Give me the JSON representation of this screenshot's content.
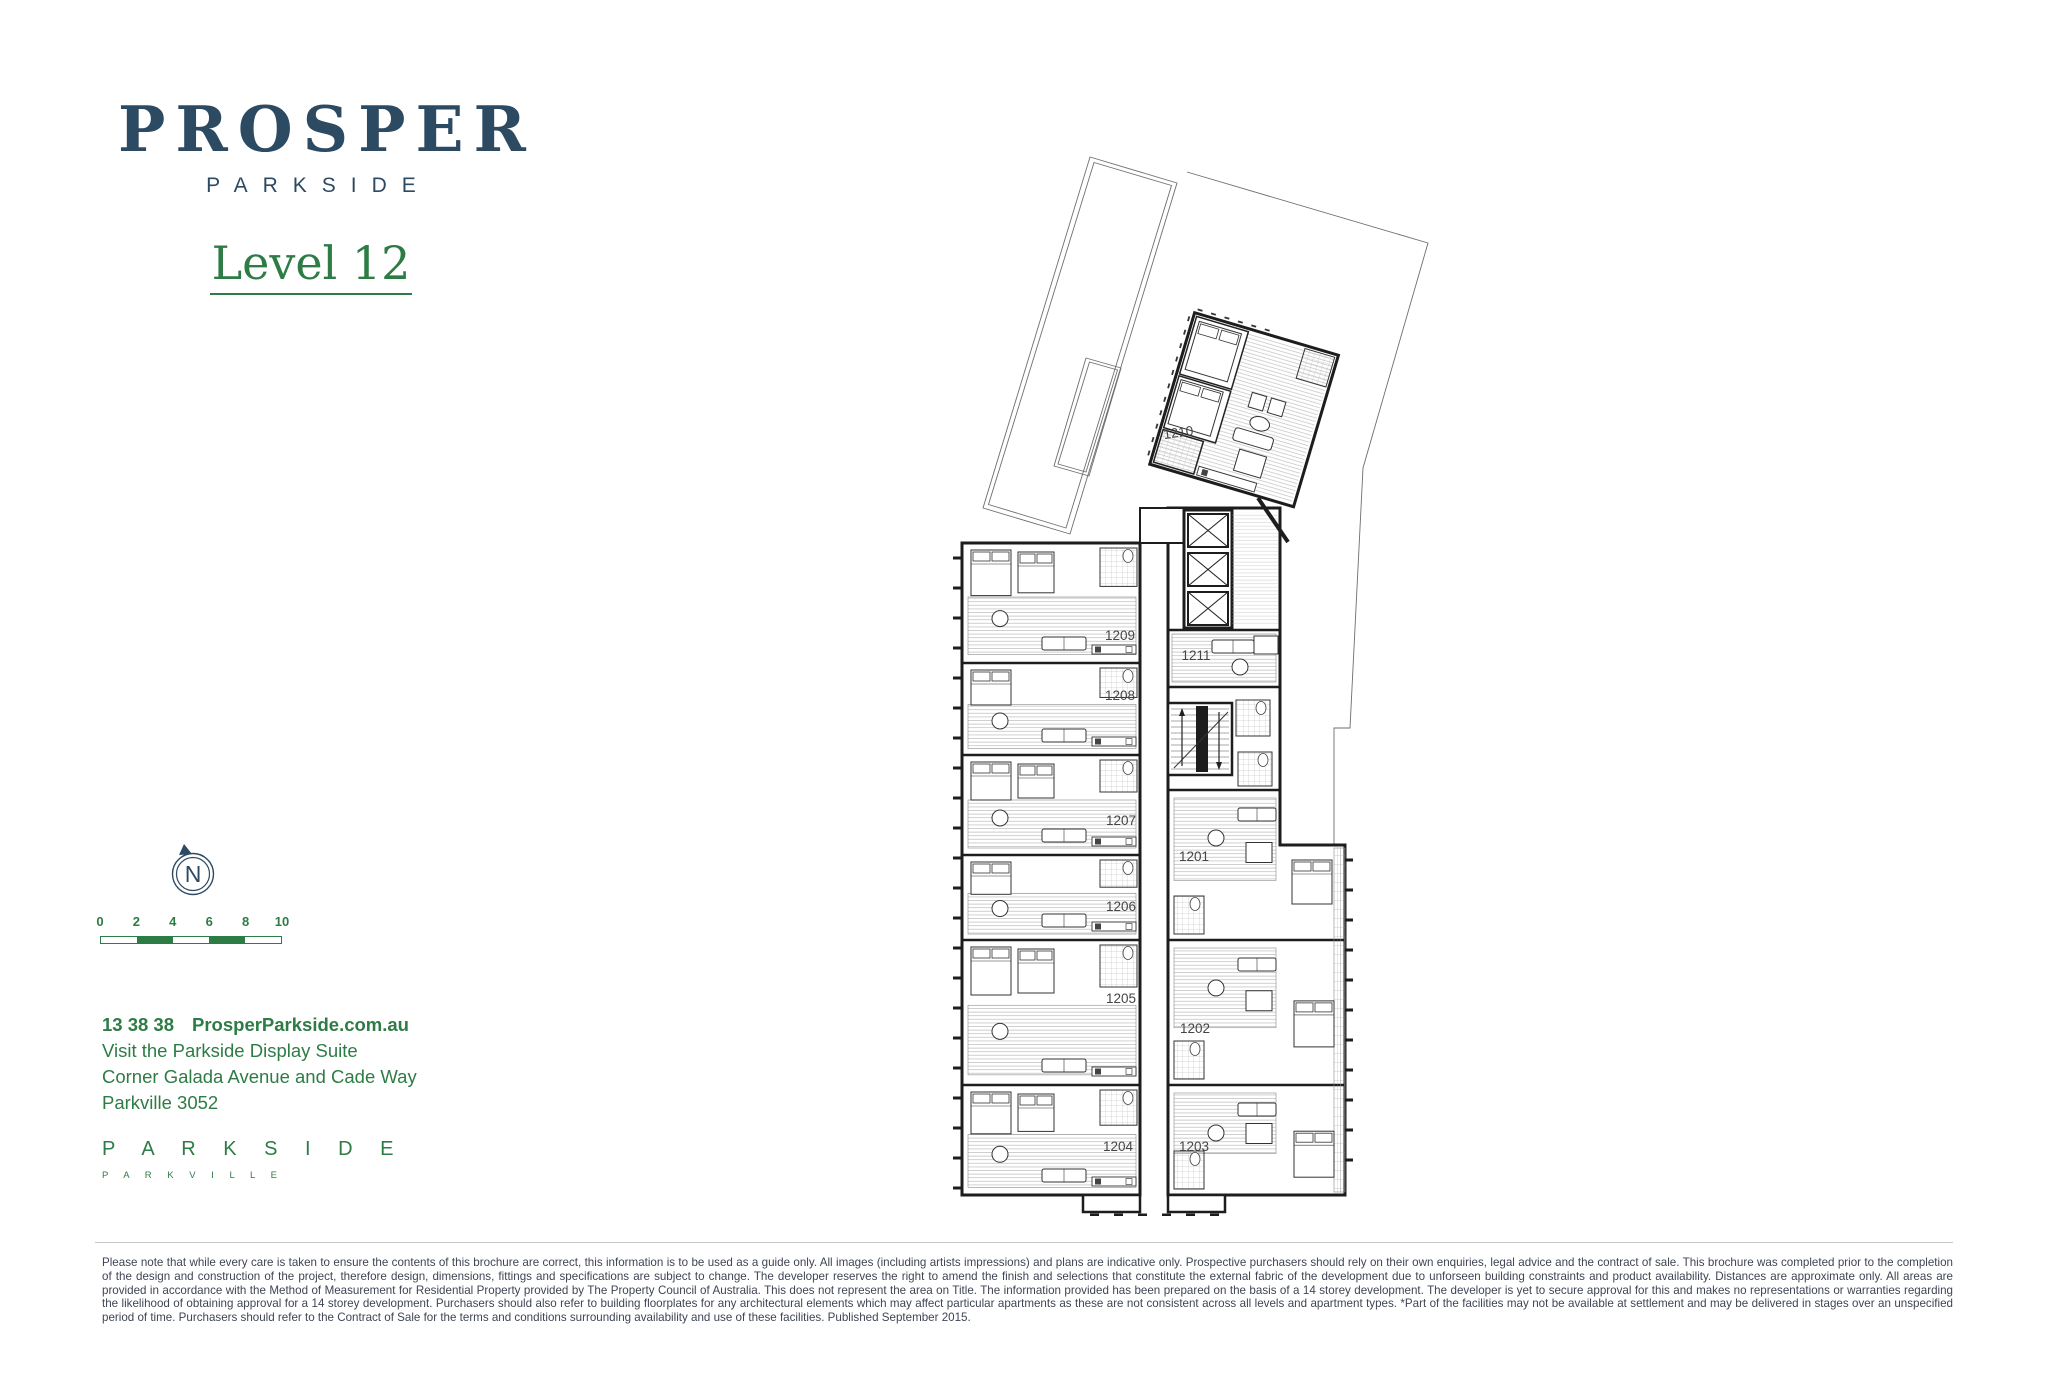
{
  "brand": {
    "name": "PROSPER",
    "sub": "PARKSIDE"
  },
  "page": {
    "level_title": "Level 12"
  },
  "compass": {
    "letter": "N"
  },
  "scale_bar": {
    "labels": [
      "0",
      "2",
      "4",
      "6",
      "8",
      "10"
    ]
  },
  "contact": {
    "phone": "13 38 38",
    "website": "ProsperParkside.com.au",
    "line2": "Visit the Parkside Display Suite",
    "line3": "Corner Galada Avenue and Cade Way",
    "line4": "Parkville 3052"
  },
  "footer_logo": {
    "name": "P A R K S I D E",
    "sub": "P A R K V I L L E"
  },
  "disclaimer": "Please note that while every care is taken to ensure the contents of this brochure are correct, this information is to be used as a guide only. All images (including artists impressions) and plans are indicative only. Prospective purchasers should rely on their own enquiries, legal advice and the contract of sale. This brochure was completed prior to the completion of the design and construction of the project, therefore design, dimensions, fittings and specifications are subject to change. The developer reserves the right to amend the finish and selections that constitute the external fabric of the development due to unforseen building constraints and product availability. Distances are approximate only. All areas are provided in accordance with the Method of Measurement for Residential Property provided by The Property Council of Australia. This does not represent the area on Title. The information provided has been prepared on the basis of a 14 storey development. The developer is yet to secure approval for this and makes no representations or warranties regarding the likelihood of obtaining approval for a 14 storey development. Purchasers should also refer to building floorplates for any architectural elements which may affect particular apartments as these are not consistent across all levels and apartment types. *Part of the facilities may not be available at settlement and may be delivered in stages over an unspecified period of time. Purchasers should refer to the Contract of Sale for the terms and conditions surrounding availability and use of these facilities. Published September 2015.",
  "floorplan": {
    "level": "12",
    "units": [
      {
        "id": "1210",
        "x": 1179,
        "y": 437,
        "rotate": -8
      },
      {
        "id": "1209",
        "x": 1120,
        "y": 640
      },
      {
        "id": "1211",
        "x": 1196,
        "y": 660
      },
      {
        "id": "1208",
        "x": 1120,
        "y": 700
      },
      {
        "id": "1207",
        "x": 1121,
        "y": 825
      },
      {
        "id": "1201",
        "x": 1194,
        "y": 861
      },
      {
        "id": "1206",
        "x": 1121,
        "y": 911
      },
      {
        "id": "1205",
        "x": 1121,
        "y": 1003
      },
      {
        "id": "1202",
        "x": 1195,
        "y": 1033
      },
      {
        "id": "1204",
        "x": 1118,
        "y": 1151
      },
      {
        "id": "1203",
        "x": 1194,
        "y": 1151
      }
    ]
  },
  "colors": {
    "navy": "#2d4a63",
    "green": "#2e7c45",
    "ink": "#3e4553",
    "wall": "#1d1d1d",
    "outline": "#6e6e6e",
    "divider": "#c2c5ca",
    "label": "#454545"
  }
}
